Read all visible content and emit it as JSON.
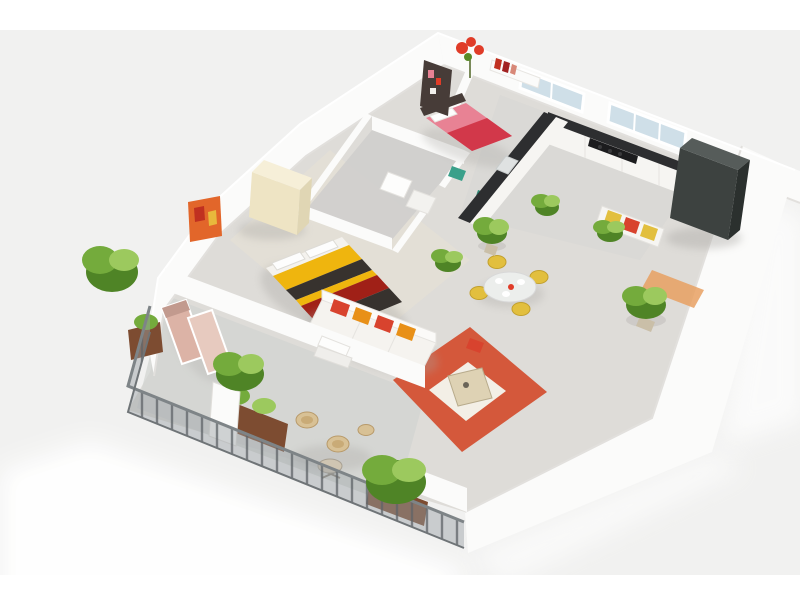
{
  "image": {
    "type": "3d-isometric-floor-plan-render",
    "description": "Bird's-eye 3D rendering of a one-bedroom apartment with open living/dining/kitchen area, bathroom, second small bedroom and a wrap-around balcony with railing, shown on a light gray backdrop with white bands at top and bottom.",
    "visible_text": "none"
  },
  "colors": {
    "backdrop": "#f1f1f0",
    "page_white": "#ffffff",
    "floor_main": "#dedcd8",
    "floor_bedroom": "#e8e2d6",
    "floor_balcony": "#d2d4d2",
    "floor_kitchen": "#d6d6d4",
    "floor_bath": "#cfcecc",
    "counter_dark": "#2d2e30",
    "cooktop_black": "#1c1c1e",
    "cabinet_white": "#f6f5f2",
    "fridge_dark": "#3d4240",
    "glass_blue": "#cfdfe8",
    "rug_orange": "#d4583b",
    "rug_inner": "#f3efe6",
    "ottoman_tan": "#ded2b4",
    "sofa_white": "#f5f3ef",
    "pillow_red": "#d8432e",
    "pillow_orange": "#e89018",
    "bed_yellow": "#efb50e",
    "bed_charcoal": "#37322e",
    "bed_red": "#a02017",
    "bed_foot_red": "#cc2a20",
    "bed2_pink": "#e88294",
    "bed2_red": "#d2384a",
    "headboard_dark": "#473c38",
    "wardrobe_cream": "#eee4c4",
    "chair_yellow": "#e2bf3e",
    "plant_green": "#74ab3c",
    "plant_dark": "#4f8426",
    "plant_light": "#9cc95e",
    "planter_brown": "#7d4c31",
    "railing_gray": "#9aa0a3",
    "railing_post": "#5f6468",
    "lounger_pink": "#dcb3a6",
    "wicker_tan": "#d8c195",
    "art_orange": "#e2662a",
    "art_red": "#c03020",
    "art_yellow": "#e8b93c",
    "decor_red": "#e03c28",
    "teal_accent": "#3aa08a",
    "hall_rug_orange": "#e8a062"
  },
  "scene": {
    "background": {
      "top_white_band_px": 30,
      "bottom_white_band_px": 25,
      "backdrop_gray": true,
      "white_ground_glow": true
    },
    "rooms": [
      {
        "name": "master-bedroom",
        "items": [
          "double bed with yellow, charcoal and red striped duvet",
          "white pillows",
          "red foot bench",
          "cream wardrobe",
          "orange wall art"
        ]
      },
      {
        "name": "second-bedroom",
        "items": [
          "single bed with pink and red bedding",
          "dark wardrobe panel",
          "wall shelf with red books",
          "red flower decor"
        ]
      },
      {
        "name": "bathroom",
        "items": [
          "enclosed room with white fixtures",
          "door opening"
        ]
      },
      {
        "name": "kitchen",
        "items": [
          "L-shaped counter with dark worktop",
          "black cooktop",
          "sink",
          "tall dark fridge cabinet",
          "two blue windows on back wall"
        ]
      },
      {
        "name": "living-room",
        "items": [
          "white sofa with red and orange pillows",
          "orange rug with white center",
          "tan ottoman",
          "colorful wall bench",
          "small orange runner rug"
        ]
      },
      {
        "name": "dining-area",
        "items": [
          "round table with plates",
          "four yellow chairs"
        ]
      },
      {
        "name": "balcony",
        "items": [
          "gray mesh railing",
          "two pink loungers",
          "two wicker chairs",
          "round side table",
          "stool",
          "brown planter boxes",
          "white post",
          "steps"
        ]
      }
    ],
    "plant_clusters_visible": 11
  }
}
